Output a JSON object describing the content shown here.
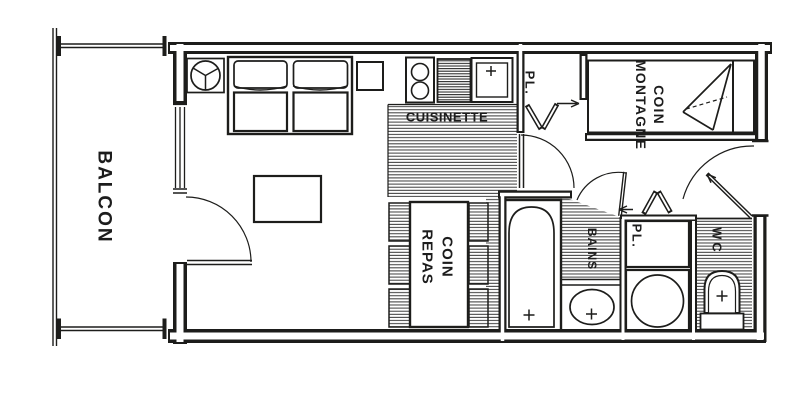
{
  "plan": {
    "colors": {
      "ink": "#1d1d1b",
      "paper": "#ffffff"
    },
    "labels": {
      "balcony": "BALCON",
      "kitchenette": "CUISINETTE",
      "dining_corner": "COIN\nREPAS",
      "mountain_corner": "COIN\nMONTAGNE",
      "bath": "BAINS",
      "wc": "WC",
      "closet_hall": "PL.",
      "closet_bath": "PL."
    }
  }
}
